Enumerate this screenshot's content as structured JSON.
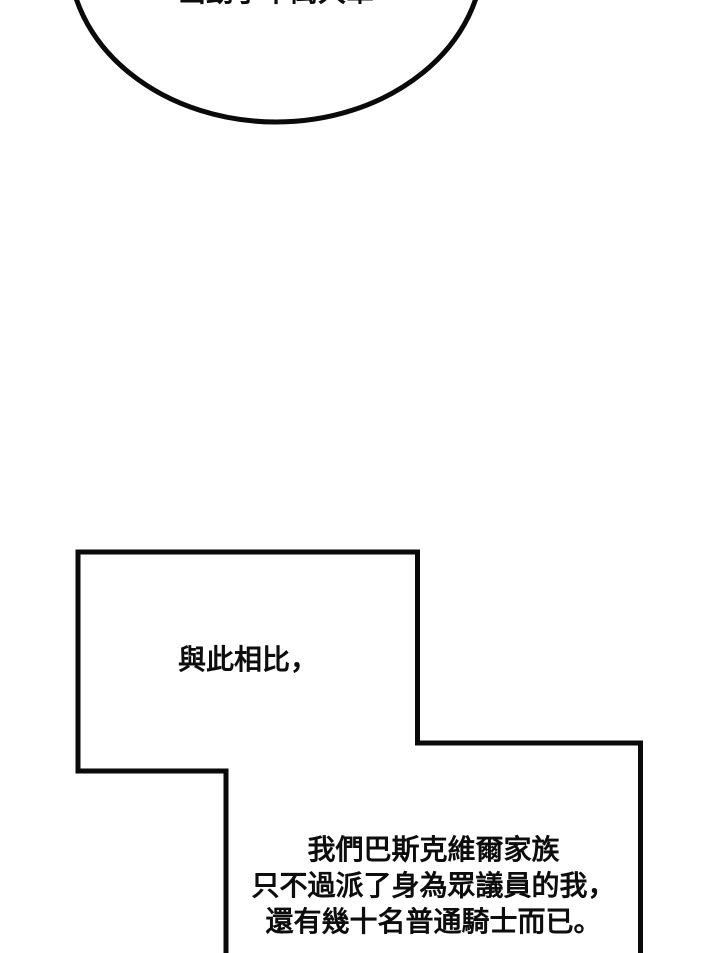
{
  "page": {
    "background": "#ffffff",
    "line_color": "#0a0a0a",
    "text_color": "#0d0d0d"
  },
  "top_bubble": {
    "clipped_text": "出動了十萬大軍"
  },
  "middle_bubble": {
    "text": "與此相比，"
  },
  "bottom_bubble": {
    "lines": [
      "我們巴斯克維爾家族",
      "只不過派了身為眾議員的我，",
      "還有幾十名普通騎士而已。"
    ]
  }
}
